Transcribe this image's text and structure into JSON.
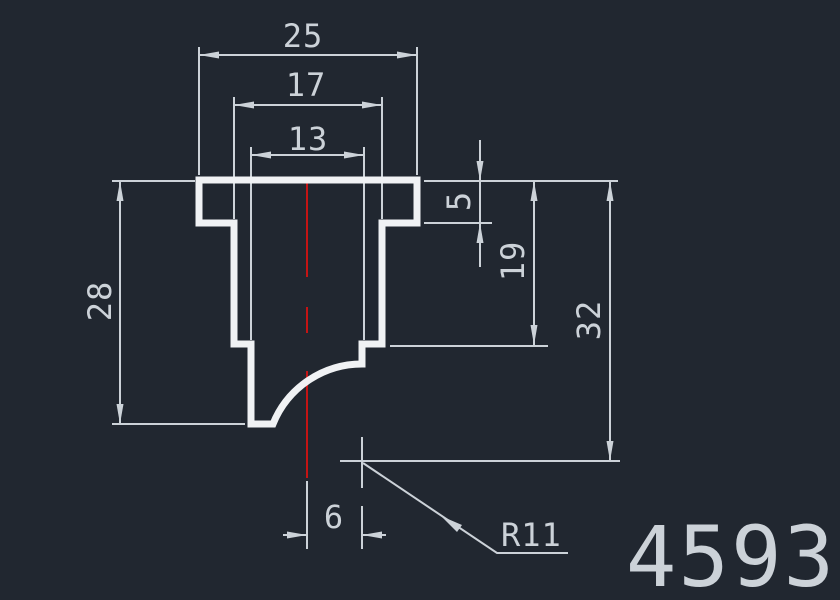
{
  "drawing": {
    "background_color": "#212730",
    "profile_color": "#f0f2f4",
    "dim_color": "#ccd2d8",
    "centerline_color": "#c41414",
    "part_number": "4593",
    "dimensions": {
      "top_outer_width": "25",
      "top_mid_width": "17",
      "top_inner_width": "13",
      "flange_thickness": "5",
      "right_step_depth": "19",
      "left_height": "28",
      "total_height": "32",
      "center_offset": "6",
      "fillet_radius": "R11"
    }
  }
}
